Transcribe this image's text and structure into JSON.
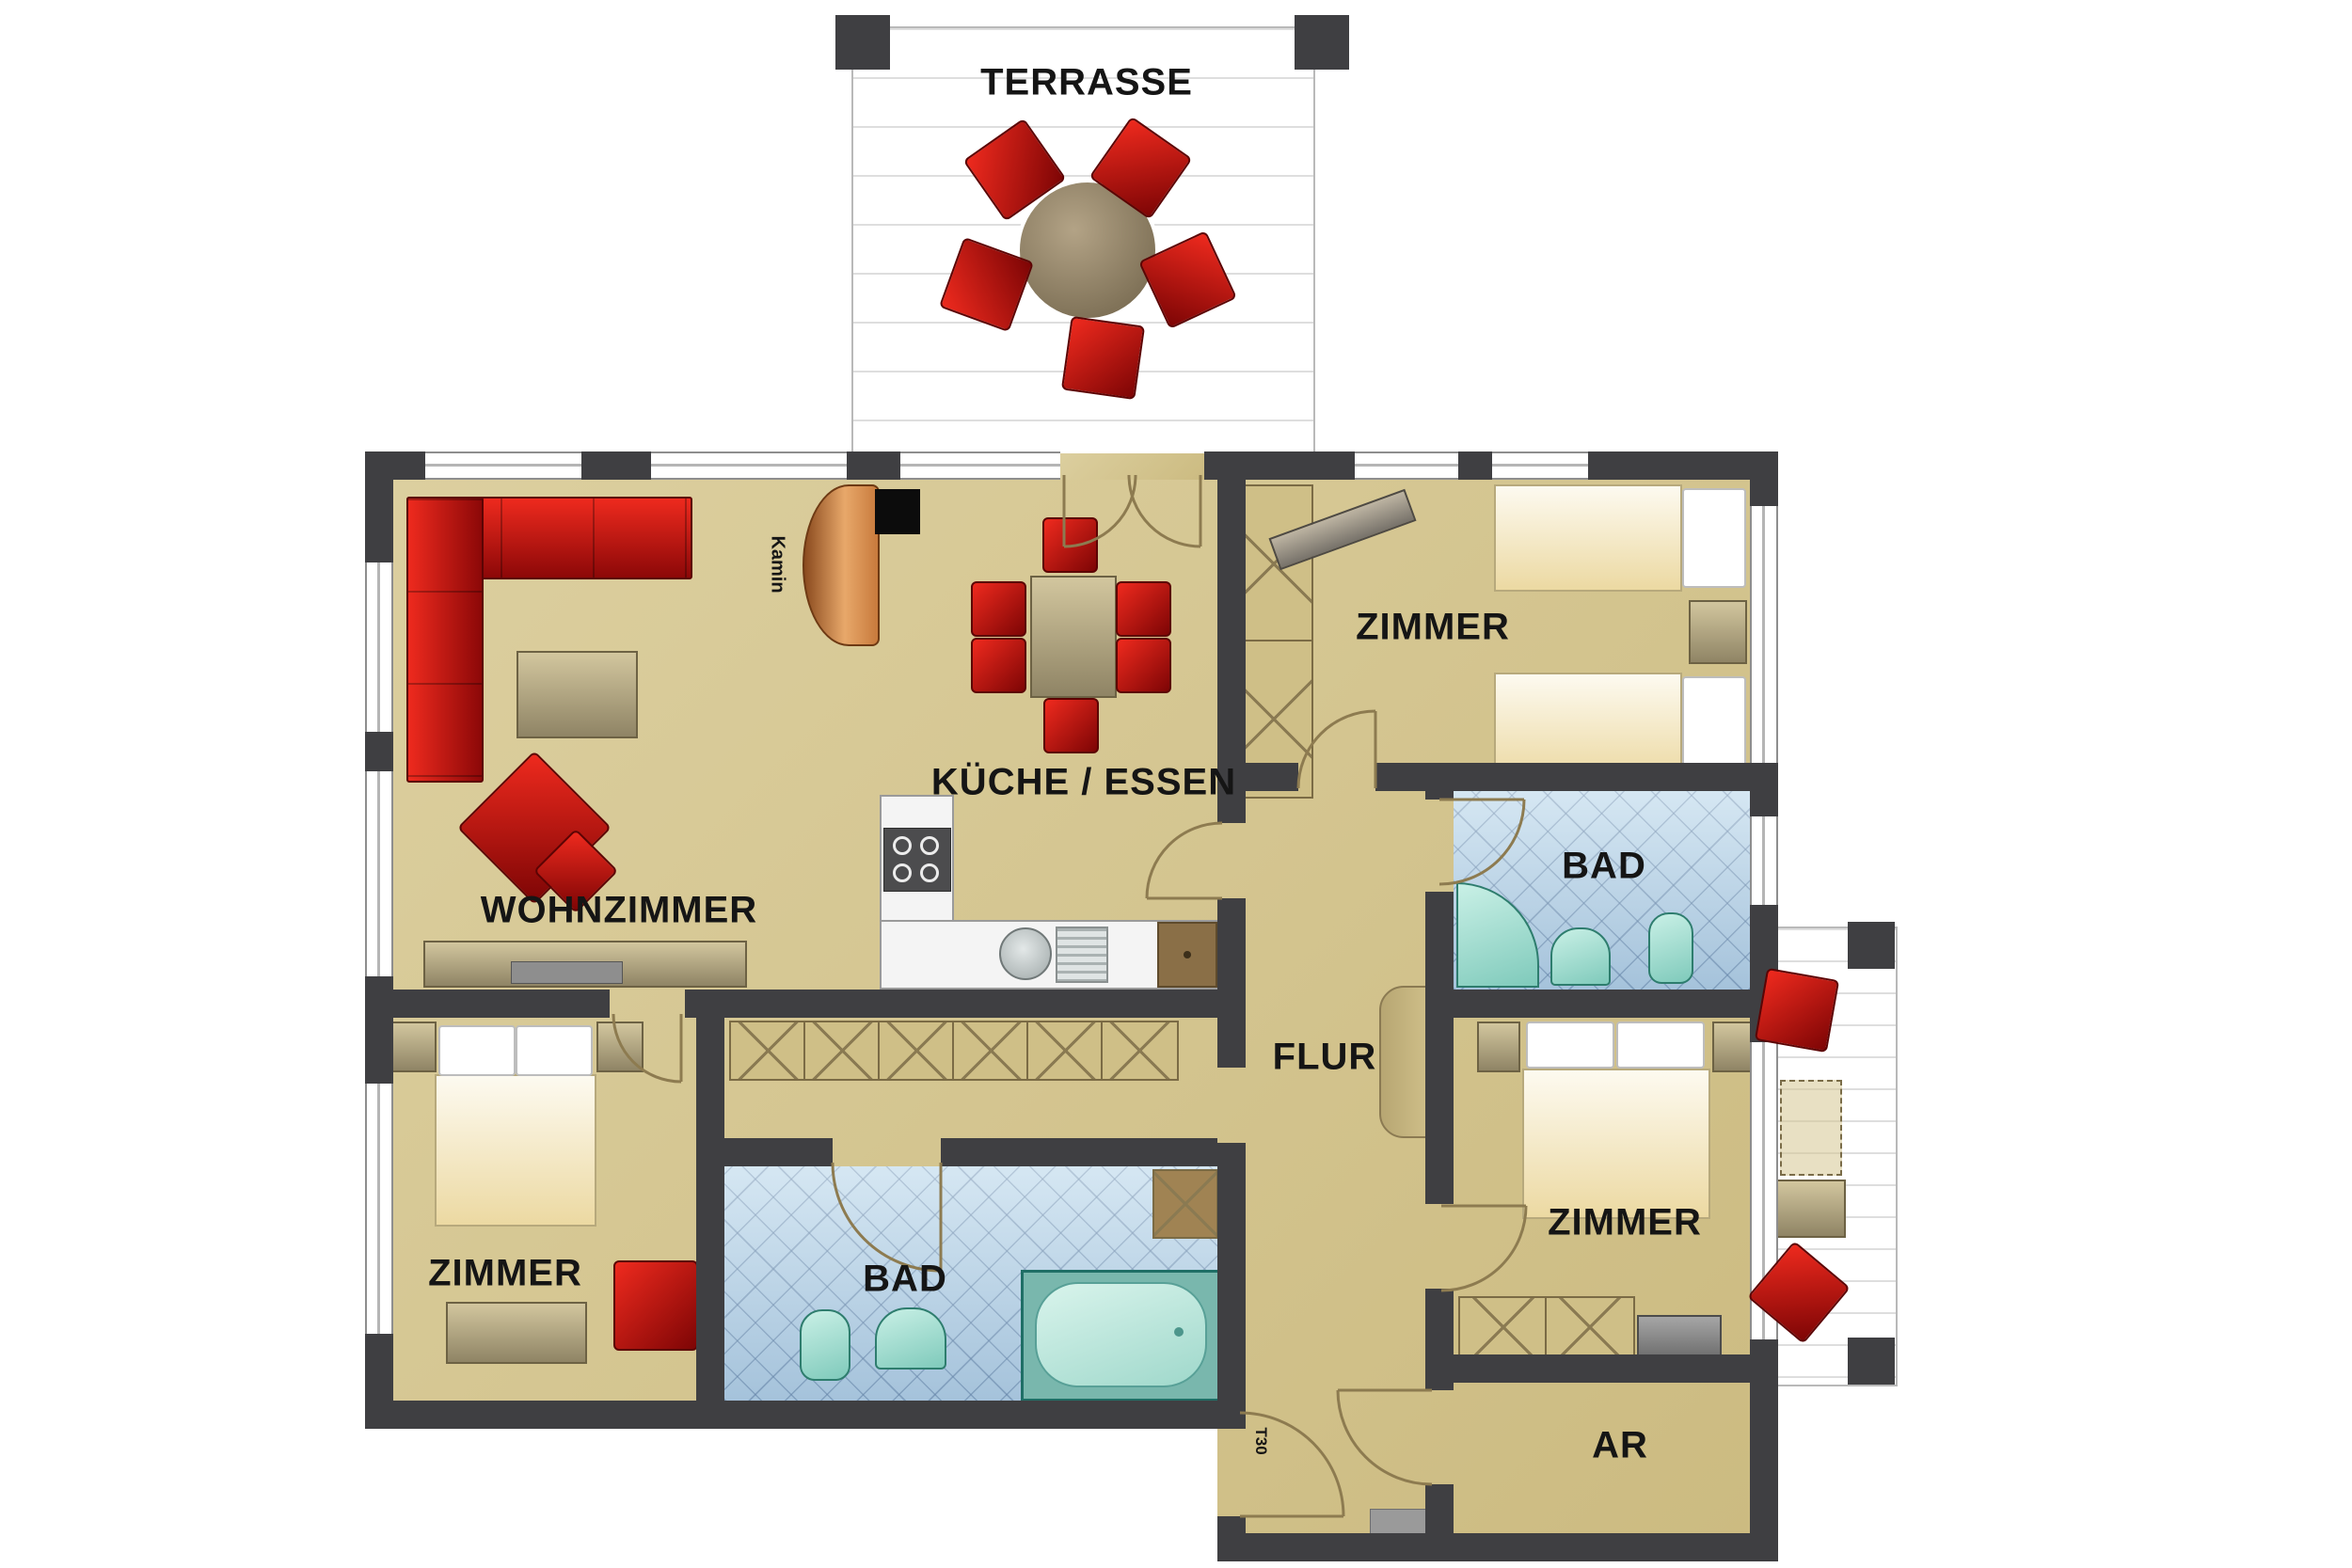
{
  "title": "apartment-floor-plan",
  "rooms": {
    "terrasse": {
      "label": "TERRASSE"
    },
    "kueche_essen": {
      "label": "KÜCHE / ESSEN"
    },
    "wohnzimmer": {
      "label": "WOHNZIMMER"
    },
    "zimmer_top": {
      "label": "ZIMMER"
    },
    "bad_top": {
      "label": "BAD"
    },
    "flur": {
      "label": "FLUR"
    },
    "zimmer_left": {
      "label": "ZIMMER"
    },
    "bad_bottom": {
      "label": "BAD"
    },
    "zimmer_right": {
      "label": "ZIMMER"
    },
    "abstellraum": {
      "label": "AR"
    }
  },
  "annotations": {
    "kamin": {
      "label": "Kamin"
    },
    "entry_door": {
      "label": "T30"
    }
  },
  "colors": {
    "wall": "#3f3f42",
    "floor": "#d5c68e",
    "furniture_red": "#c01414",
    "bath_tile": "#bfdaec",
    "sanitary": "#8fd8c9",
    "kamin_copper": "#c87a3c",
    "label_text": "#151515"
  }
}
